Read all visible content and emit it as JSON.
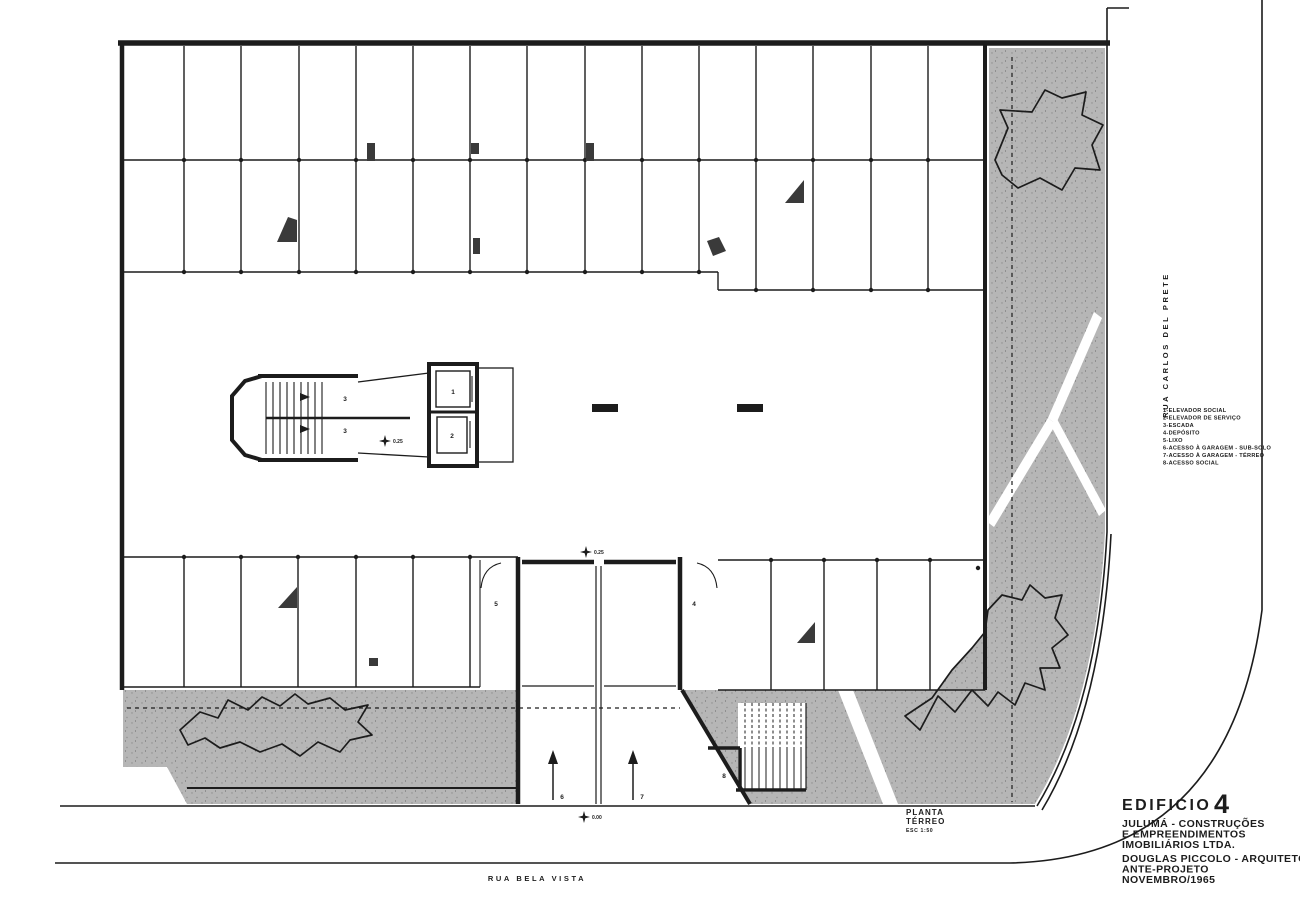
{
  "sheet": {
    "plan_caption": {
      "line1": "PLANTA",
      "line2": "TÉRREO",
      "scale": "ESC 1:50"
    },
    "title_block": {
      "building_label": "EDIFICIO",
      "building_number": "4",
      "client_line1": "JULUMÁ - CONSTRUÇÕES",
      "client_line2": "E EMPREENDIMENTOS",
      "client_line3": "IMOBILIÁRIOS LTDA.",
      "architect": "DOUGLAS PICCOLO - ARQUITETO",
      "phase": "ANTE-PROJETO",
      "date": "NOVEMBRO/1965"
    },
    "streets": {
      "bottom": "RUA BELA VISTA",
      "right": "RUA CARLOS DEL PRETE"
    },
    "legend": {
      "items": [
        "1-ELEVADOR SOCIAL",
        "2-ELEVADOR DE SERVIÇO",
        "3-ESCADA",
        "4-DEPÓSITO",
        "5-LIXO",
        "6-ACESSO À GARAGEM - SUB-SOLO",
        "7-ACESSO À GARAGEM - TÉRREO",
        "8-ACESSO SOCIAL"
      ]
    },
    "plan_marks": {
      "stair_upper": "3",
      "stair_lower": "3",
      "elevator_social": "1",
      "elevator_service": "2",
      "small_room_left": "5",
      "small_room_right": "4",
      "ramp_basement": "6",
      "ramp_ground": "7",
      "social_access": "8"
    },
    "levels": {
      "core": "0.25",
      "ramp": "0.25",
      "street": "0.00"
    },
    "colors": {
      "ink": "#1c1c1c",
      "paper": "#ffffff",
      "pavement": "#b6b6b6"
    }
  }
}
